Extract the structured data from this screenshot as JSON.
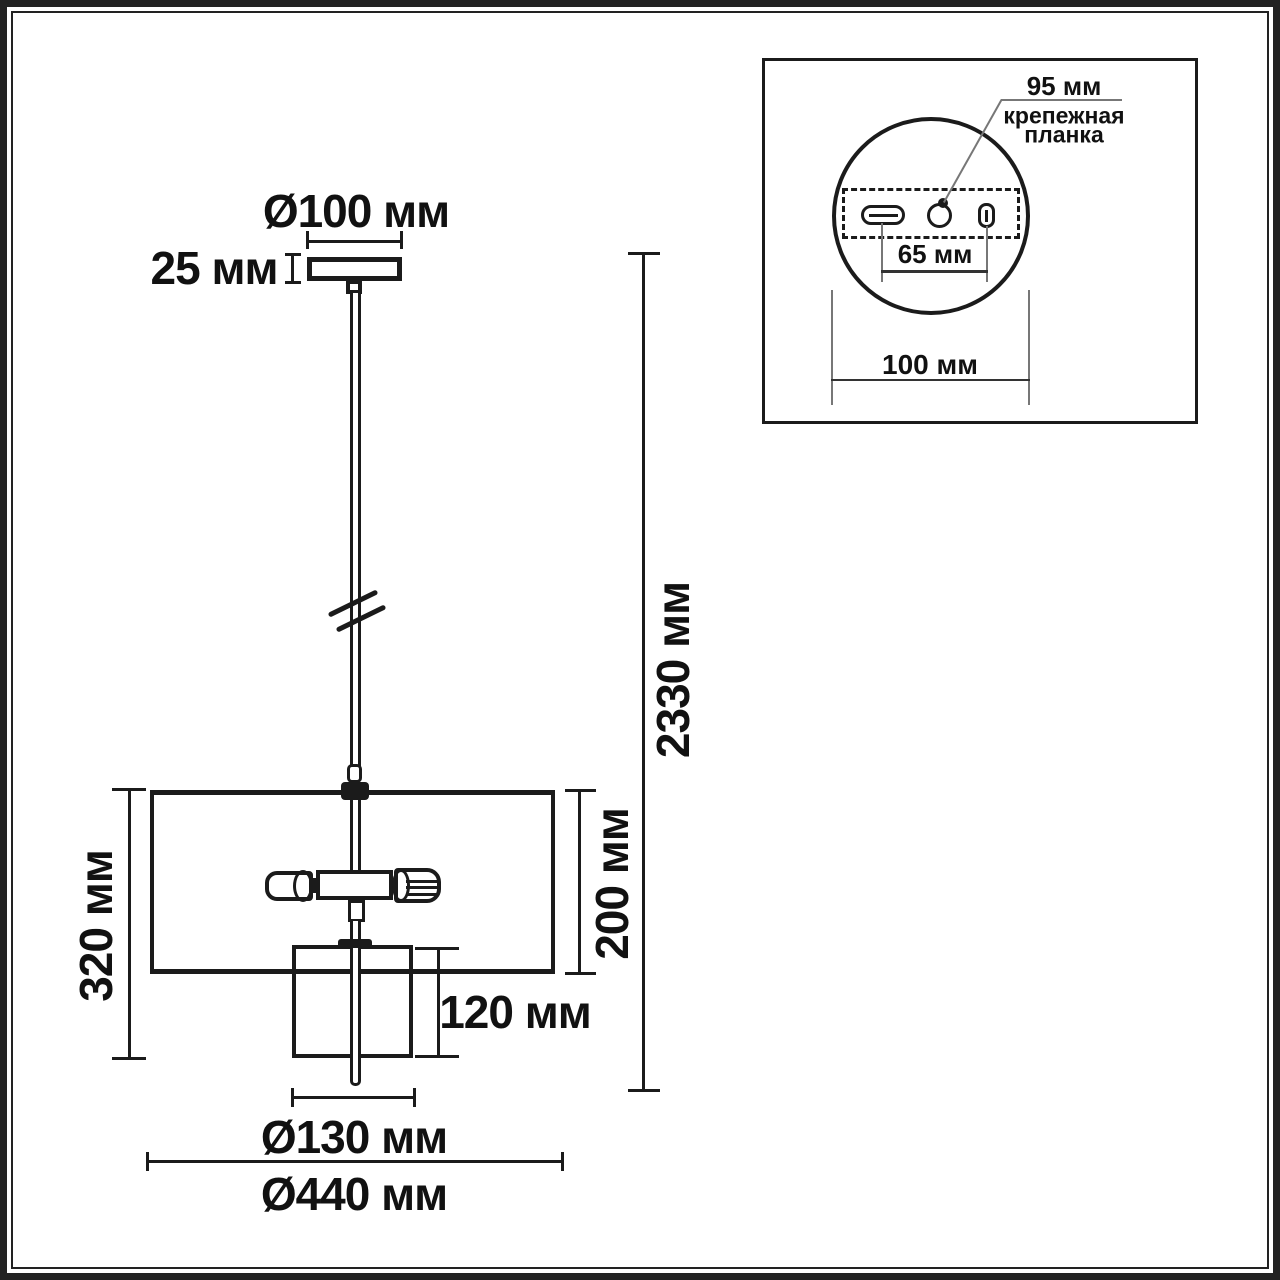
{
  "drawing": {
    "type": "pendant-light-dimension-diagram",
    "unit": "мм",
    "ink_color": "#1b1b1b",
    "background_color": "#ffffff",
    "main_view": {
      "canopy_diameter": "Ø100 мм",
      "canopy_height": "25 мм",
      "overall_height": "2330 мм",
      "fixture_height": "320 мм",
      "shade_height": "200 мм",
      "inner_shade_height": "120 мм",
      "inner_shade_diameter": "Ø130 мм",
      "shade_diameter": "Ø440 мм"
    },
    "inset_view": {
      "plate_width": "95 мм",
      "plate_label_line1": "крепежная",
      "plate_label_line2": "планка",
      "hole_spacing": "65 мм",
      "canopy_footprint": "100 мм"
    }
  }
}
